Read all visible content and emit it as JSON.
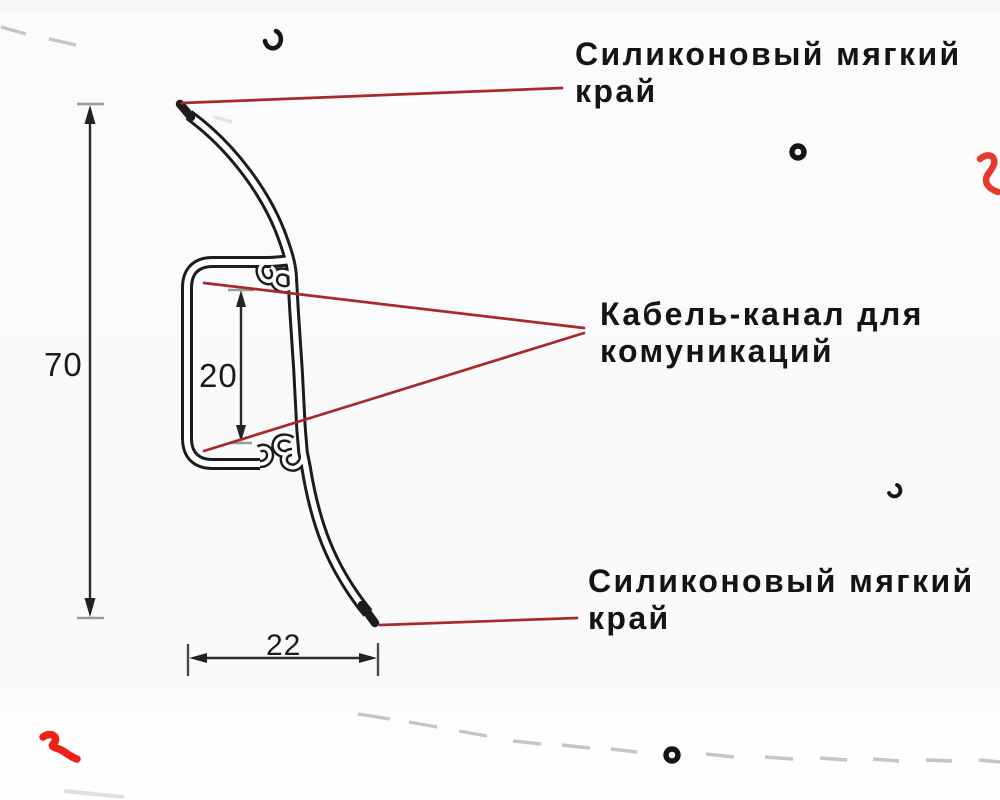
{
  "labels": {
    "top_edge": {
      "line1": "Силиконовый мягкий",
      "line2": "край"
    },
    "cable_channel": {
      "line1": "Кабель-канал для",
      "line2": "комуникаций"
    },
    "bottom_edge": {
      "line1": "Силиконовый мягкий",
      "line2": "край"
    }
  },
  "dimensions": {
    "height": "70",
    "channel_height": "20",
    "width": "22"
  },
  "colors": {
    "outline": "#1c1c1c",
    "leader_line": "#a8292b",
    "squiggle_red": "#e8261b",
    "dash_gray": "#c4c5c8",
    "tick_gray": "#9a9a9e",
    "text": "#141414",
    "background": "#fafbfa"
  }
}
